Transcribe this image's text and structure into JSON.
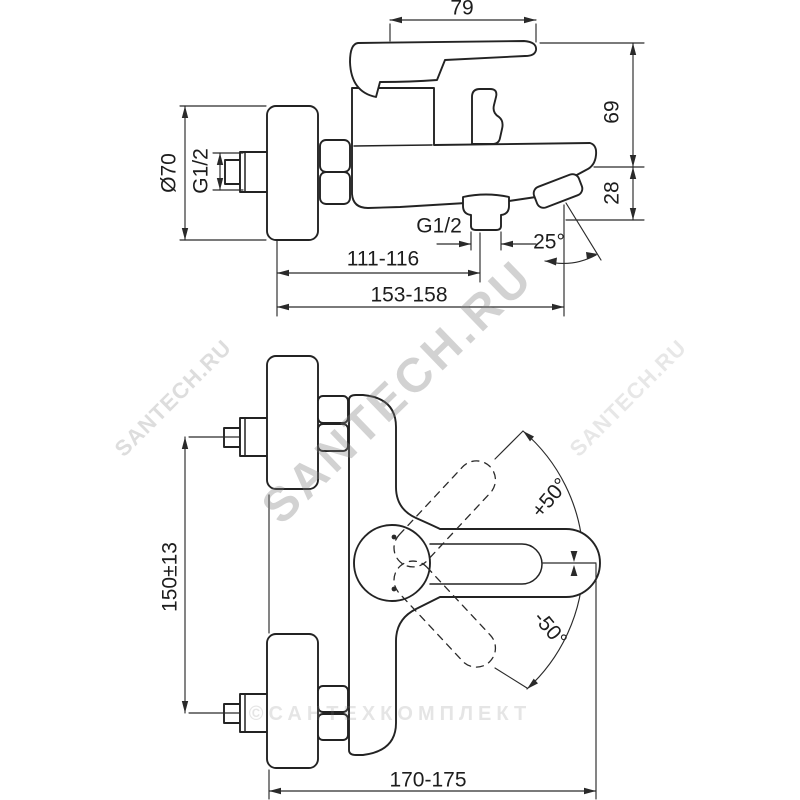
{
  "page": {
    "background": "#ffffff"
  },
  "drawing": {
    "type": "technical-dimension-drawing",
    "subject": "wall-mounted single-lever bath mixer tap, side view and plan view",
    "line_color": "#232323",
    "watermark_color": "#8c8c8c",
    "side_view": {
      "dims": {
        "handle_width": "79",
        "upper_height": "69",
        "spout_height": "28",
        "flange_diameter": "Ø70",
        "inlet_thread": "G1/2",
        "outlet_thread": "G1/2",
        "wall_to_outlet": "111-116",
        "wall_to_spout_tip": "153-158",
        "spout_angle": "25°"
      }
    },
    "top_view": {
      "dims": {
        "union_spacing": "150±13",
        "total_reach": "170-175",
        "swing_plus": "+50°",
        "swing_minus": "-50°"
      }
    },
    "watermarks": {
      "brand": "SANTECH.RU",
      "brand_left": "SANTECH.RU",
      "brand_right": "SANTECH.RU",
      "copyright": "©САНТЕХКОМПЛЕКТ"
    }
  }
}
